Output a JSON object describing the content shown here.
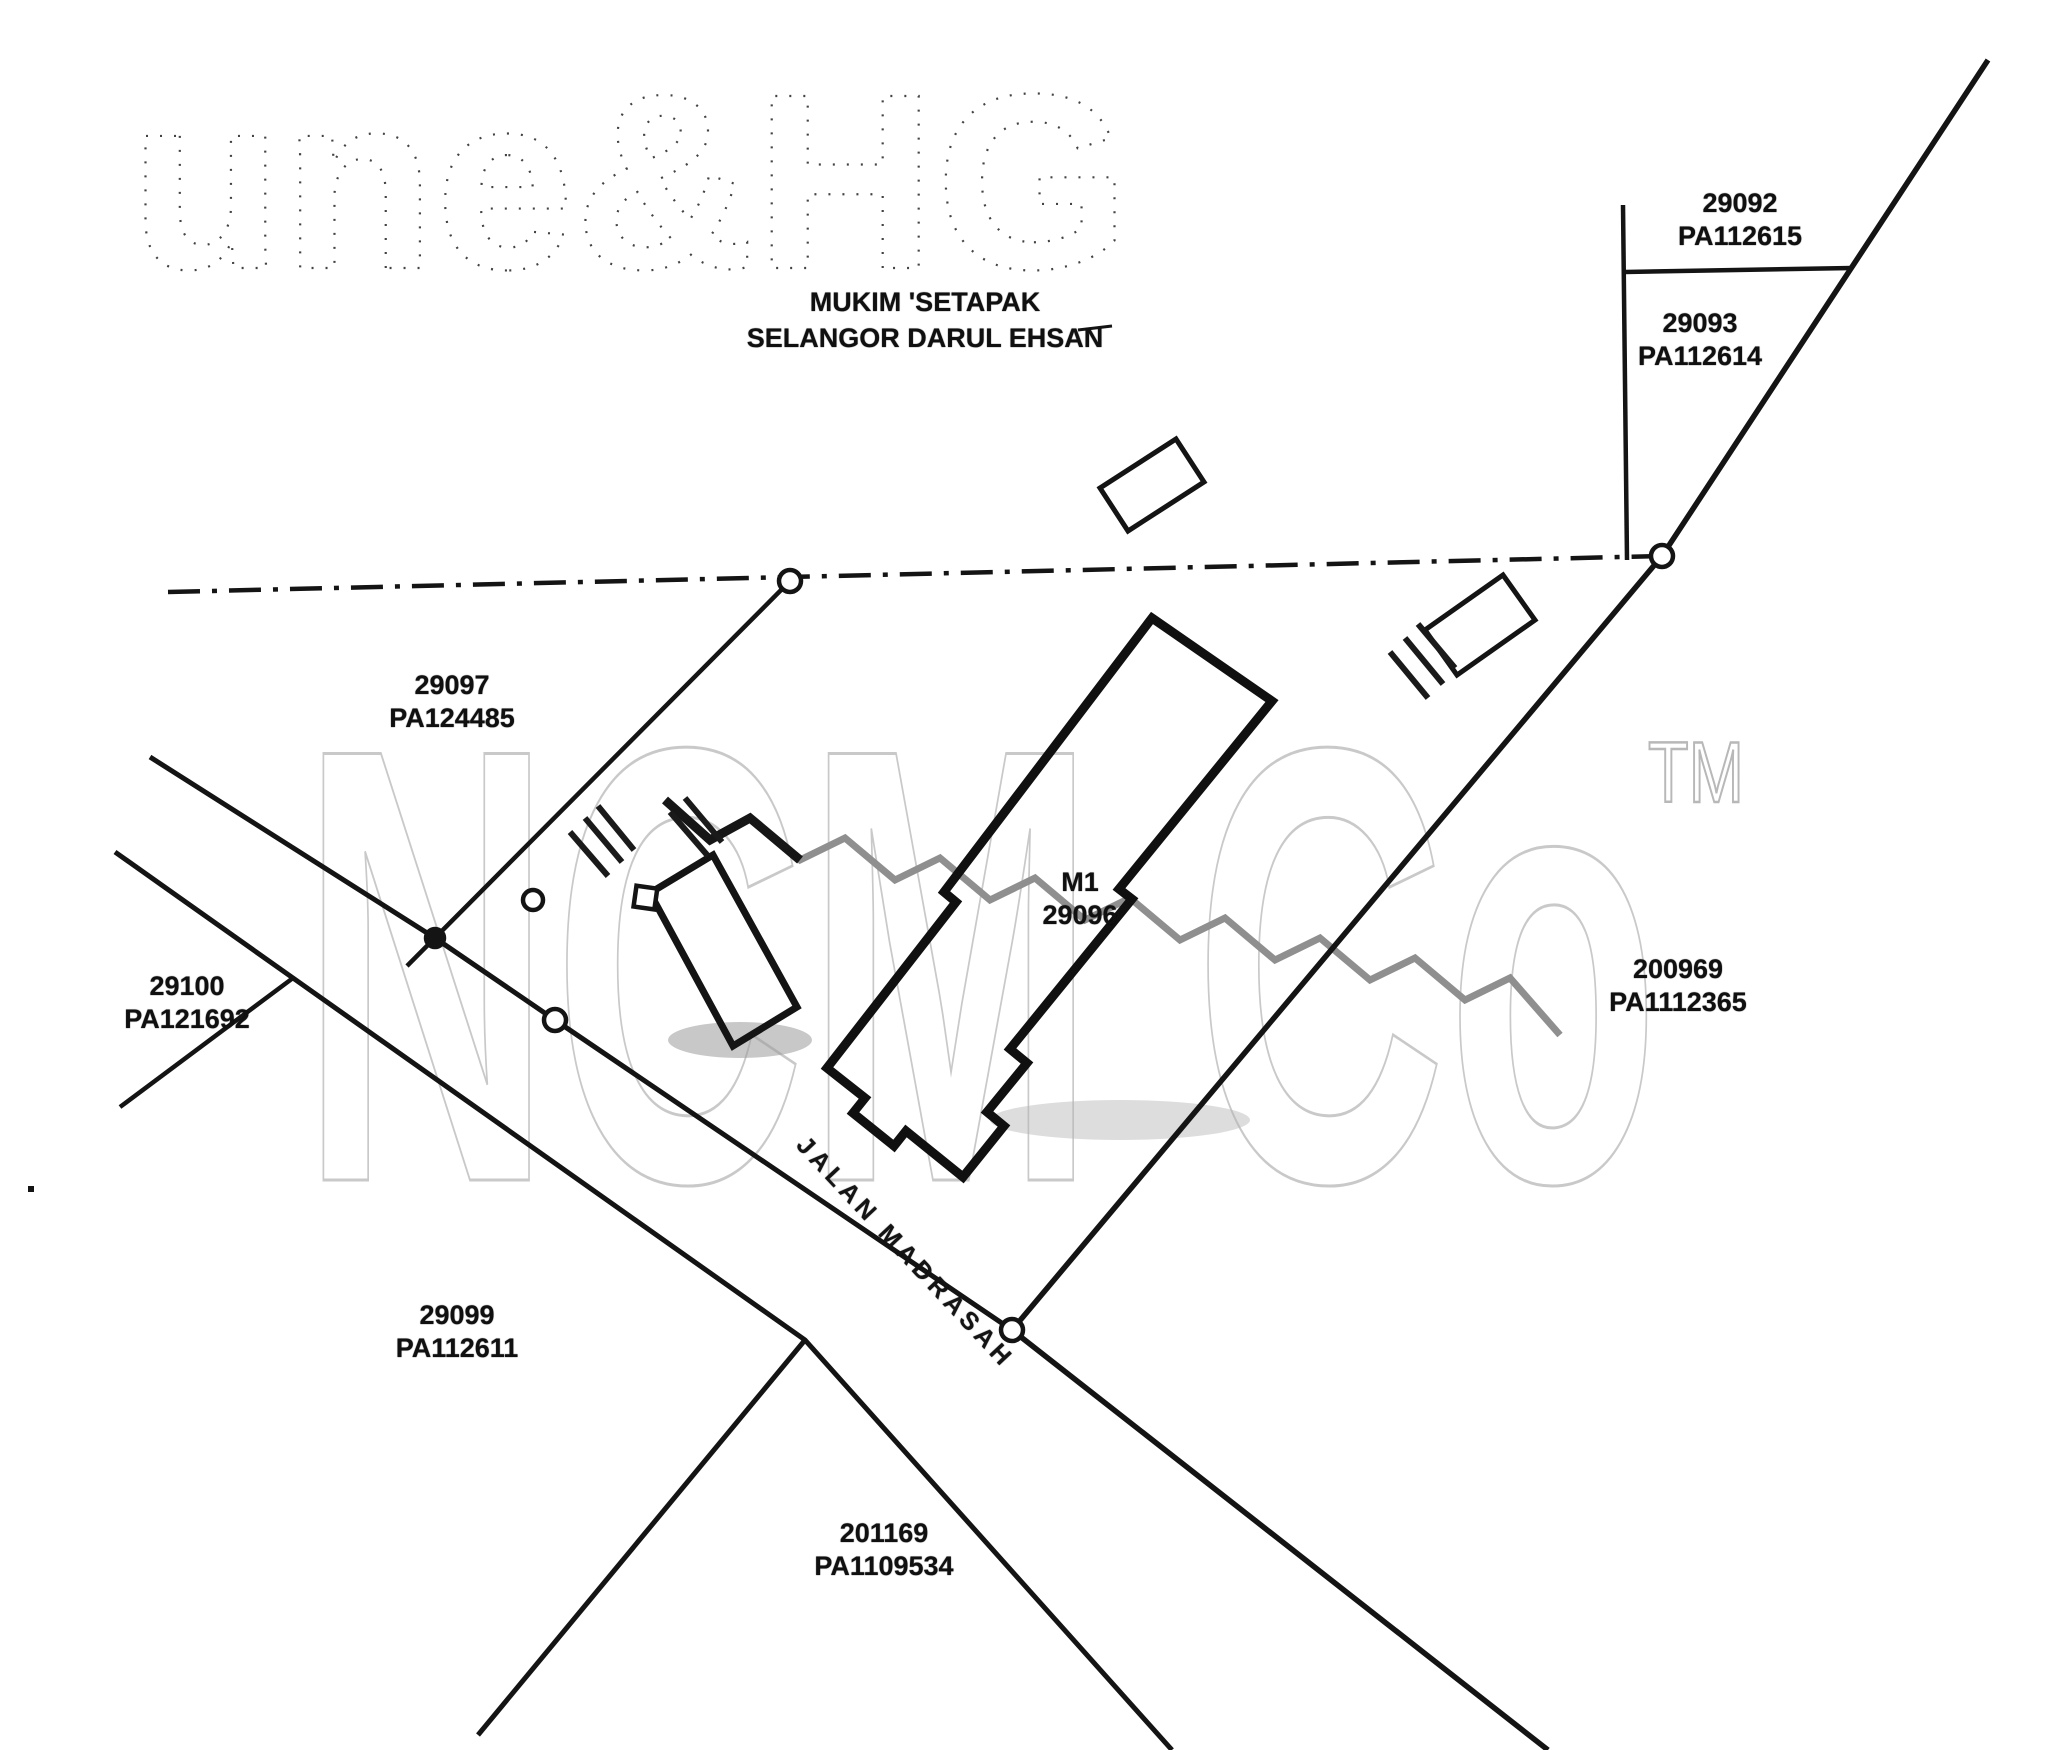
{
  "page": {
    "background": "#ffffff",
    "ink": "#141414",
    "watermark_color": "#c9c9c9"
  },
  "header": {
    "ghost_text": "une&HG",
    "area_line1": "MUKIM 'SETAPAK",
    "area_line2": "SELANGOR DARUL EHSAN"
  },
  "watermark": {
    "brand": "NCM Co",
    "tm": "TM"
  },
  "road": {
    "name": "JALAN MADRASAH"
  },
  "building": {
    "line1": "M1",
    "line2": "29096"
  },
  "parcels": [
    {
      "lot": "29092",
      "pa": "PA112615"
    },
    {
      "lot": "29093",
      "pa": "PA112614"
    },
    {
      "lot": "29097",
      "pa": "PA124485"
    },
    {
      "lot": "29100",
      "pa": "PA121692"
    },
    {
      "lot": "200969",
      "pa": "PA1112365"
    },
    {
      "lot": "29099",
      "pa": "PA112611"
    },
    {
      "lot": "201169",
      "pa": "PA1109534"
    }
  ]
}
